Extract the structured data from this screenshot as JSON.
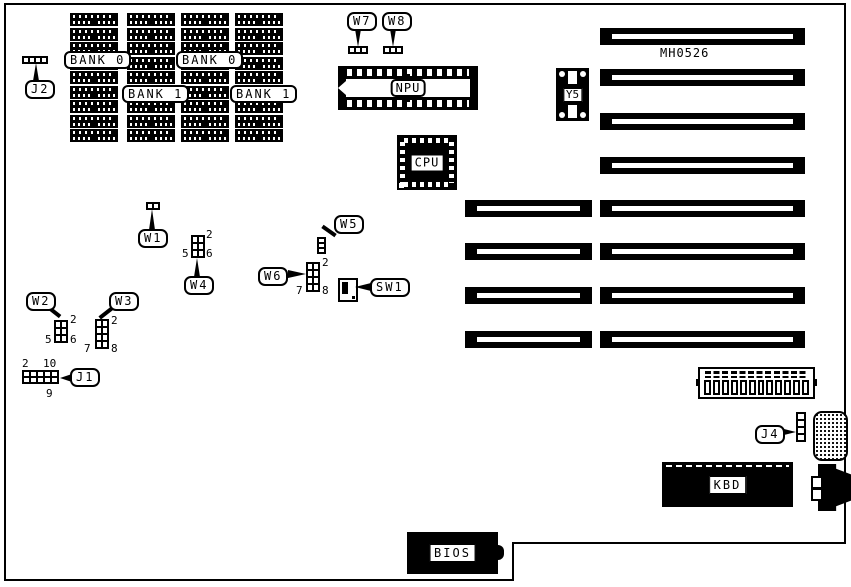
{
  "diagram": {
    "part_number": "MH0526",
    "colors": {
      "ink": "#000000",
      "background": "#ffffff"
    },
    "memory": {
      "bank_labels": [
        "BANK 0",
        "BANK 0",
        "BANK 1",
        "BANK 1"
      ]
    },
    "chips": {
      "npu": "NPU",
      "cpu": "CPU",
      "y5": "Y5",
      "kbd": "KBD",
      "bios": "BIOS"
    },
    "jumpers": {
      "j2": {
        "label": "J2"
      },
      "w1": {
        "label": "W1"
      },
      "w2": {
        "label": "W2",
        "pins": {
          "top_right": "2",
          "bottom_left": "5",
          "bottom_right": "6"
        }
      },
      "w3": {
        "label": "W3",
        "pins": {
          "top_right": "2",
          "bottom_left": "7",
          "bottom_right": "8"
        }
      },
      "w4": {
        "label": "W4",
        "pins": {
          "top_right": "2",
          "bottom_left": "5",
          "bottom_right": "6"
        }
      },
      "w5": {
        "label": "W5"
      },
      "w6": {
        "label": "W6",
        "pins": {
          "top_right": "2",
          "bottom_left": "7",
          "bottom_right": "8"
        }
      },
      "w7": {
        "label": "W7"
      },
      "w8": {
        "label": "W8"
      },
      "sw1": {
        "label": "SW1"
      },
      "j1": {
        "label": "J1",
        "pins": {
          "top_left": "2",
          "top_right": "10",
          "bottom_right": "9"
        }
      },
      "j4": {
        "label": "J4"
      }
    }
  }
}
